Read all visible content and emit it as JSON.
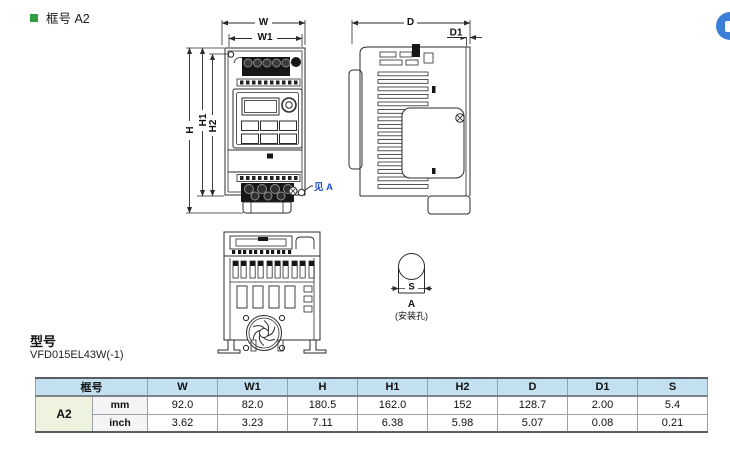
{
  "page": {
    "section_title": "框号 A2",
    "model_label": "型号",
    "model_value": "VFD015EL43W(-1)"
  },
  "drawing": {
    "front": {
      "w": "W",
      "w1": "W1",
      "h": "H",
      "h1": "H1",
      "h2": "H2",
      "see_a": "见 A"
    },
    "side": {
      "d": "D",
      "d1": "D1"
    },
    "detail": {
      "s": "S",
      "a": "A",
      "note": "(安装孔)"
    }
  },
  "table": {
    "frame_header": "框号",
    "frame_value": "A2",
    "units": [
      "mm",
      "inch"
    ],
    "columns": [
      "W",
      "W1",
      "H",
      "H1",
      "H2",
      "D",
      "D1",
      "S"
    ],
    "mm": [
      "92.0",
      "82.0",
      "180.5",
      "162.0",
      "152",
      "128.7",
      "2.00",
      "5.4"
    ],
    "inch": [
      "3.62",
      "3.23",
      "7.11",
      "6.38",
      "5.98",
      "5.07",
      "0.08",
      "0.21"
    ]
  },
  "colors": {
    "accent_green": "#2e9e41",
    "callout_blue": "#1d4ed8",
    "table_header_bg": "#c3e0f1",
    "frame_cell_bg": "#eef3e0",
    "unit_cell_bg": "#f4f4f4",
    "widget_blue": "#3c7fd9"
  }
}
